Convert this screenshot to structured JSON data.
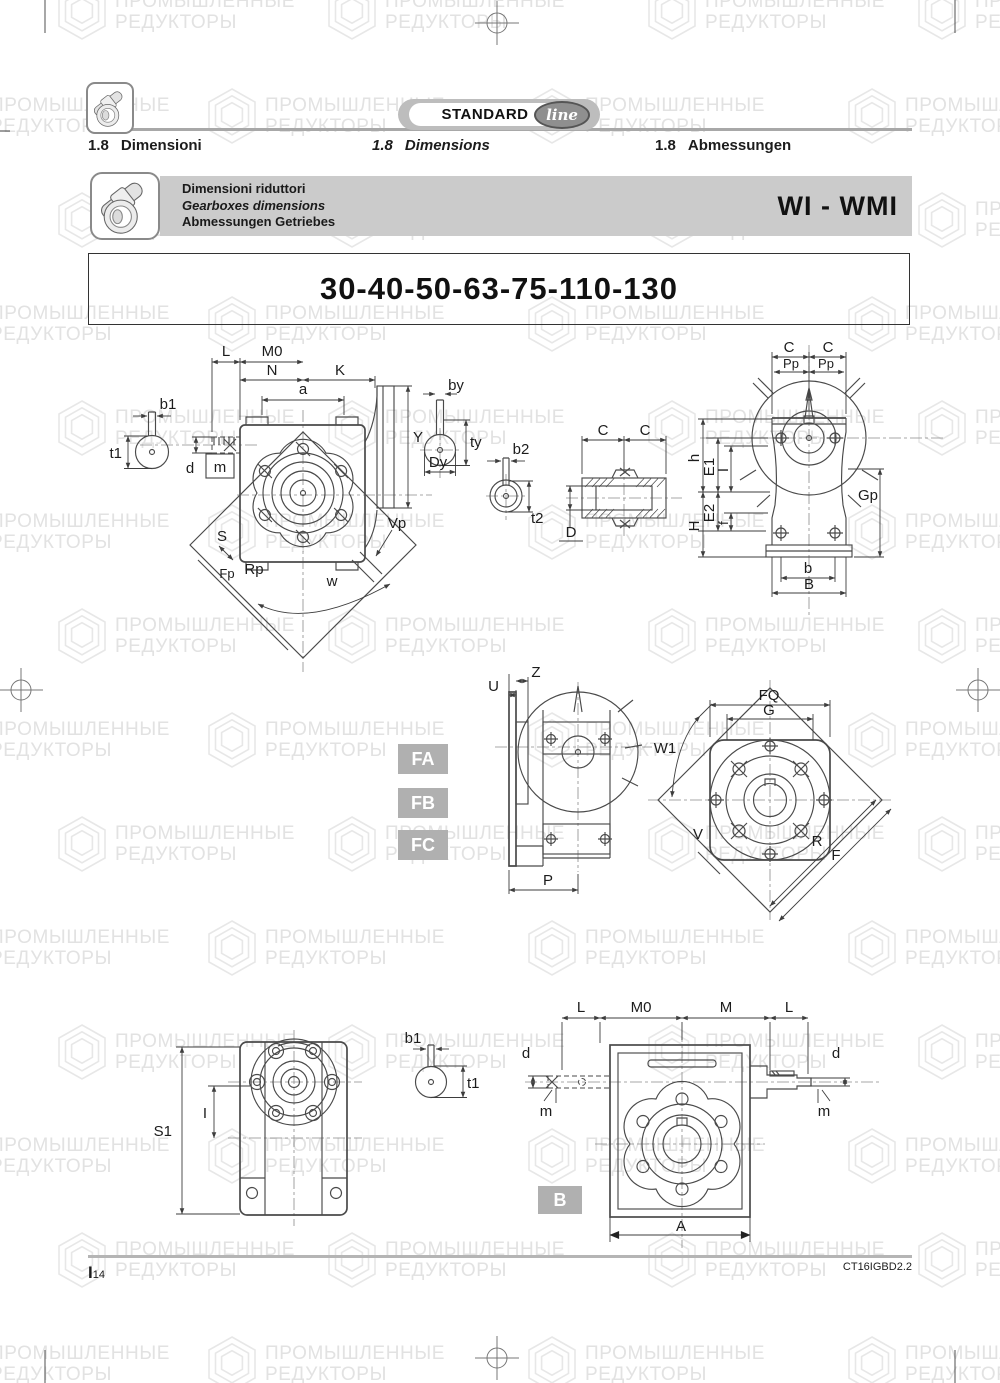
{
  "page": {
    "watermark_line1": "ПРОМЫШЛЕННЫЕ",
    "watermark_line2": "РЕДУКТОРЫ"
  },
  "header": {
    "logo": {
      "standard": "STANDARD",
      "line": "line"
    },
    "sections": {
      "it_num": "1.8",
      "it": "Dimensioni",
      "en_num": "1.8",
      "en": "Dimensions",
      "de_num": "1.8",
      "de": "Abmessungen"
    },
    "banner": {
      "it": "Dimensioni riduttori",
      "en": "Gearboxes dimensions",
      "de": "Abmessungen Getriebes",
      "series": "WI - WMI"
    },
    "title": "30-40-50-63-75-110-130"
  },
  "badges": {
    "fa": "FA",
    "fb": "FB",
    "fc": "FC",
    "b": "B"
  },
  "labels": {
    "d1": {
      "L": "L",
      "M0": "M0",
      "N": "N",
      "K": "K",
      "a": "a",
      "b1": "b1",
      "t1": "t1",
      "d": "d",
      "m": "m",
      "S": "S",
      "Fp": "Fp",
      "Rp": "Rp",
      "w": "w",
      "Vp": "Vp",
      "Y": "Y",
      "by": "by",
      "ty": "ty",
      "Dy": "Dy",
      "b2": "b2",
      "t2": "t2",
      "C1": "C",
      "C2": "C",
      "D": "D"
    },
    "d3": {
      "C1": "C",
      "C2": "C",
      "Pp1": "Pp",
      "Pp2": "Pp",
      "h": "h",
      "E1": "E1",
      "I": "I",
      "E2": "E2",
      "f": "f",
      "H": "H",
      "Gp": "Gp",
      "b": "b",
      "B": "B"
    },
    "d4": {
      "U": "U",
      "Z": "Z",
      "P": "P"
    },
    "d5": {
      "FQ": "FQ",
      "G": "G",
      "W1": "W1",
      "V": "V",
      "R": "R",
      "F": "F"
    },
    "d6": {
      "S1": "S1",
      "I": "I",
      "b1": "b1",
      "t1": "t1"
    },
    "d7": {
      "L1": "L",
      "M0": "M0",
      "M": "M",
      "L2": "L",
      "d1": "d",
      "d2": "d",
      "m1": "m",
      "m2": "m",
      "A": "A"
    }
  },
  "footer": {
    "page_prefix": "I",
    "page_num": "14",
    "doc_code": "CT16IGBD2.2"
  },
  "colors": {
    "banner_bg": "#cbcbcb",
    "badge_bg": "#b0b0b0",
    "line_dark": "#3d3d3d"
  }
}
